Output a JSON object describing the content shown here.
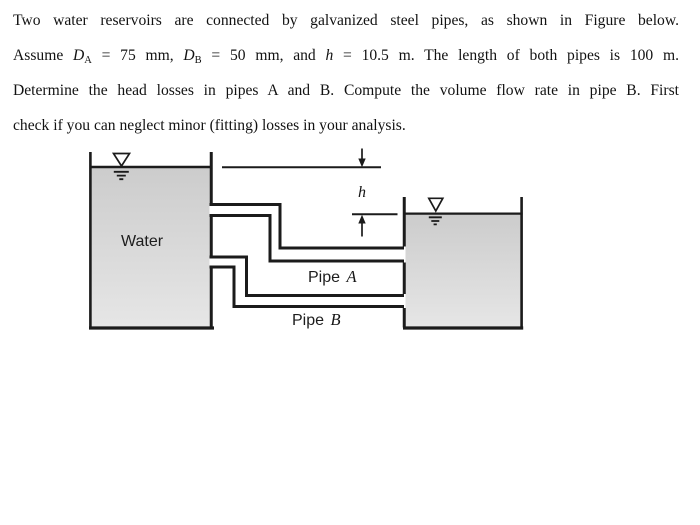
{
  "colors": {
    "ink": "#1b1b1b",
    "water_fill_top": "#cccccc",
    "water_fill_bottom": "#e6e6e6",
    "background": "#ffffff"
  },
  "problem": {
    "lines": [
      {
        "justify": true,
        "segments": [
          {
            "t": "Two water reservoirs are connected by galvanized steel pipes, as shown in Figure below."
          }
        ]
      },
      {
        "justify": true,
        "segments": [
          {
            "t": "Assume "
          },
          {
            "t": "D",
            "s": "i"
          },
          {
            "t": "A",
            "s": "sub"
          },
          {
            "t": " = 75 mm, "
          },
          {
            "t": "D",
            "s": "i"
          },
          {
            "t": "B",
            "s": "sub"
          },
          {
            "t": " = 50 mm, and "
          },
          {
            "t": "h",
            "s": "i"
          },
          {
            "t": " = 10.5 m. The length of both pipes is 100 m."
          }
        ]
      },
      {
        "justify": true,
        "segments": [
          {
            "t": "Determine the head losses in pipes A and B. Compute the volume flow rate in pipe B. First"
          }
        ]
      },
      {
        "justify": false,
        "segments": [
          {
            "t": "check if you can neglect minor (fitting) losses in your analysis."
          }
        ]
      }
    ]
  },
  "figure": {
    "labels": {
      "left_tank": "Water",
      "pipe_a_prefix": "Pipe ",
      "pipe_a_letter": "A",
      "pipe_b_prefix": "Pipe ",
      "pipe_b_letter": "B",
      "height_dim": "h"
    }
  }
}
